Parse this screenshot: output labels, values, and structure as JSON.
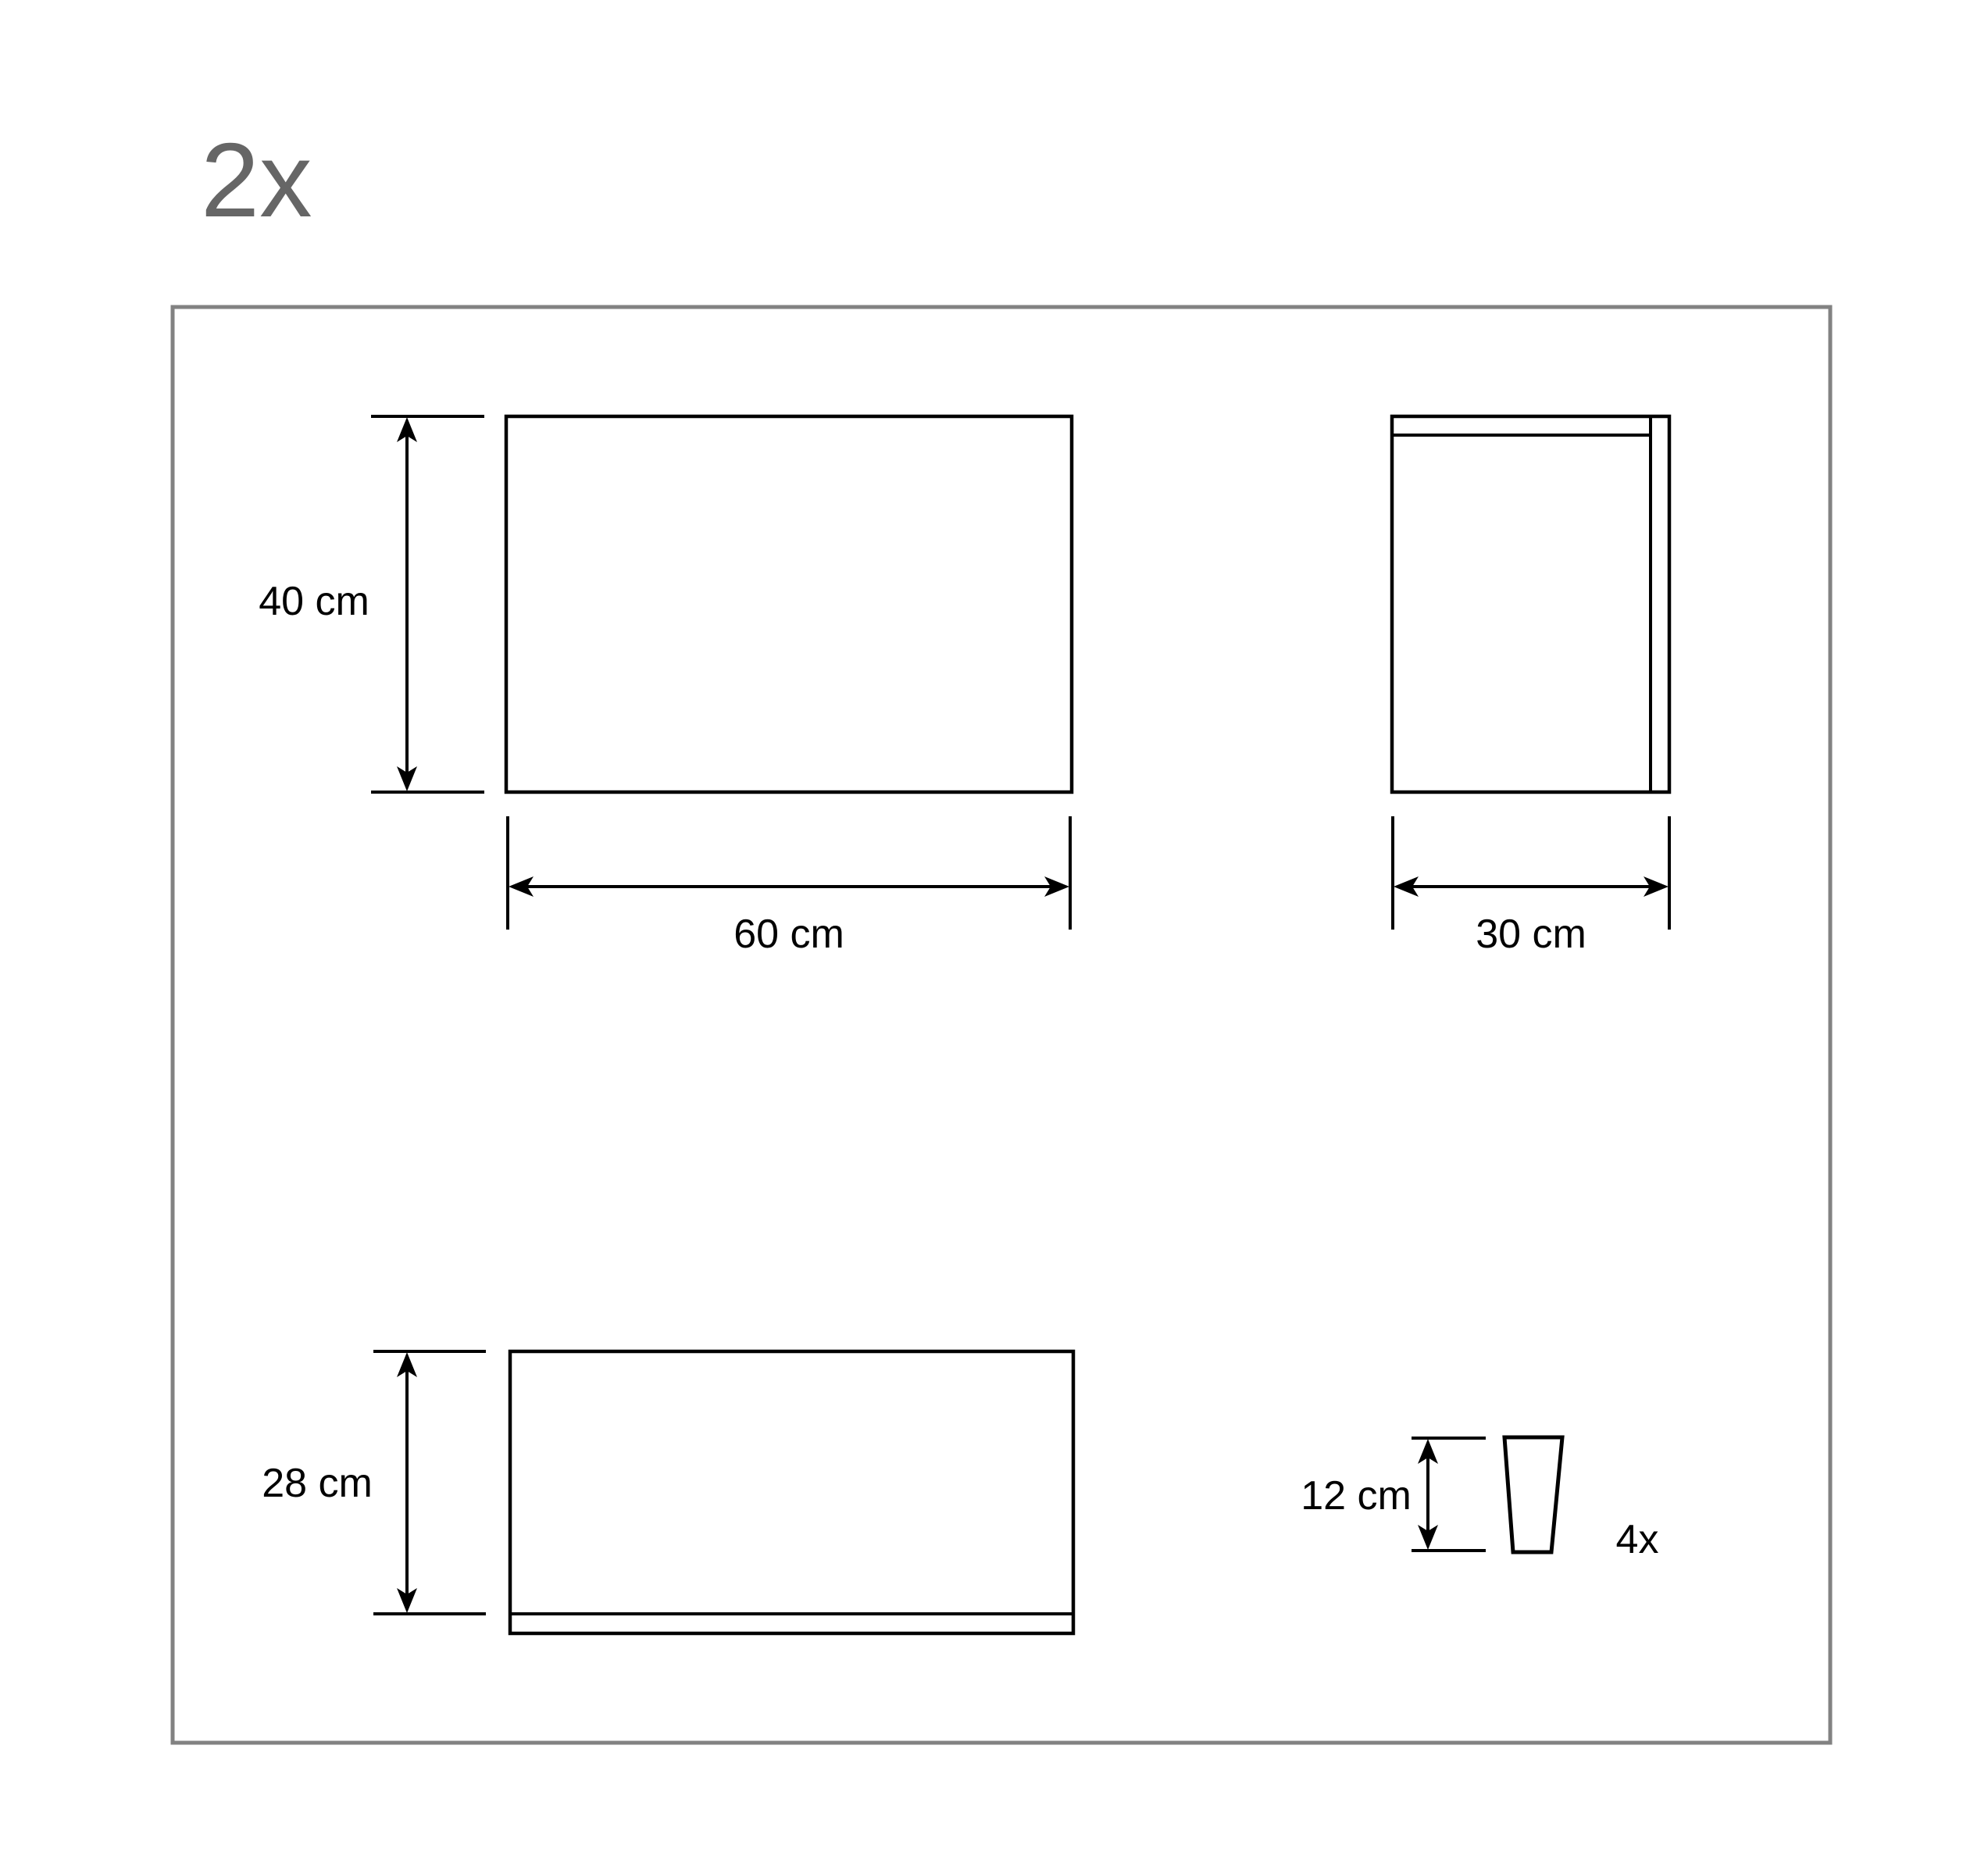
{
  "colors": {
    "line": "#000000",
    "border_gray": "#828282",
    "quantity_gray": "#666666"
  },
  "sheet": {
    "quantity": "2x"
  },
  "figures": {
    "front_panel": {
      "height": "40 cm",
      "width": "60 cm"
    },
    "side_panel": {
      "width": "30 cm"
    },
    "shelf_panel": {
      "height": "28 cm"
    },
    "leg": {
      "height": "12 cm",
      "quantity": "4x"
    }
  }
}
